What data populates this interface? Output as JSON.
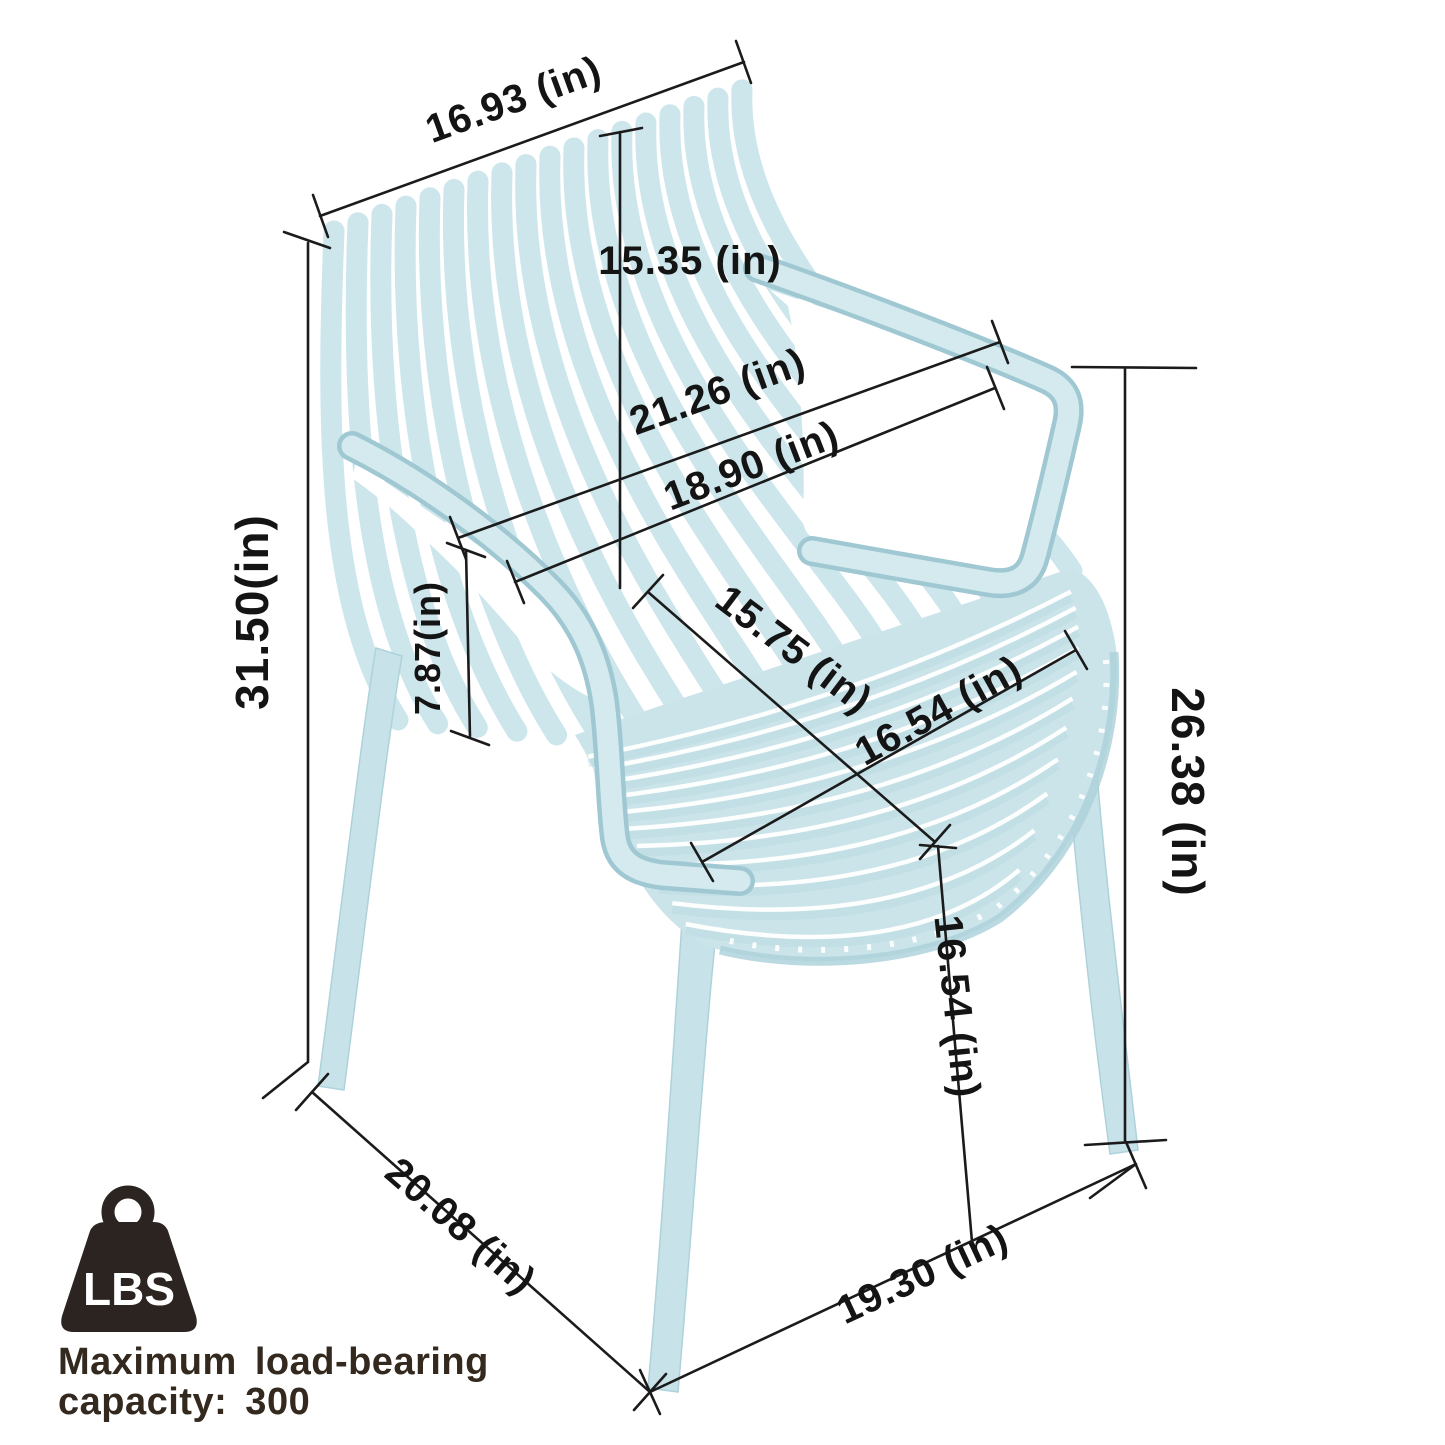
{
  "diagram": {
    "type": "product-dimension-diagram",
    "product": "stackable slatted plastic armchair",
    "chair_color": "#cde6ec",
    "background": "#ffffff",
    "units": "in"
  },
  "measurements": [
    {
      "id": "backrest-top-width",
      "value": "16.93",
      "text": "16.93 (in)"
    },
    {
      "id": "backrest-height",
      "value": "15.35",
      "text": "15.35 (in)"
    },
    {
      "id": "armrest-span-width",
      "value": "21.26",
      "text": "21.26 (in)"
    },
    {
      "id": "seat-back-width",
      "value": "18.90",
      "text": "18.90 (in)"
    },
    {
      "id": "overall-height",
      "value": "31.50",
      "text": "31.50(in)"
    },
    {
      "id": "backrest-to-seat",
      "value": "7.87",
      "text": "7.87(in)"
    },
    {
      "id": "seat-depth",
      "value": "15.75",
      "text": "15.75 (in)"
    },
    {
      "id": "seat-width",
      "value": "16.54",
      "text": "16.54 (in)"
    },
    {
      "id": "armrest-floor-height",
      "value": "26.38",
      "text": "26.38 (in)"
    },
    {
      "id": "seat-floor-height",
      "value": "16.54",
      "text": "16.54 (in)"
    },
    {
      "id": "base-depth",
      "value": "20.08",
      "text": "20.08 (in)"
    },
    {
      "id": "base-width",
      "value": "19.30",
      "text": "19.30 (in)"
    }
  ],
  "load_badge": {
    "icon": "weight-icon",
    "icon_label": "LBS",
    "caption_line1": "Maximum load-bearing",
    "caption_line2": "capacity: 300"
  },
  "colors": {
    "chair_base": "#cde6ec",
    "chair_shade": "#aed2db",
    "chair_light": "#d4eaee",
    "dim_line": "#1b1b1b",
    "badge": "#2b2421",
    "caption": "#33291f"
  }
}
